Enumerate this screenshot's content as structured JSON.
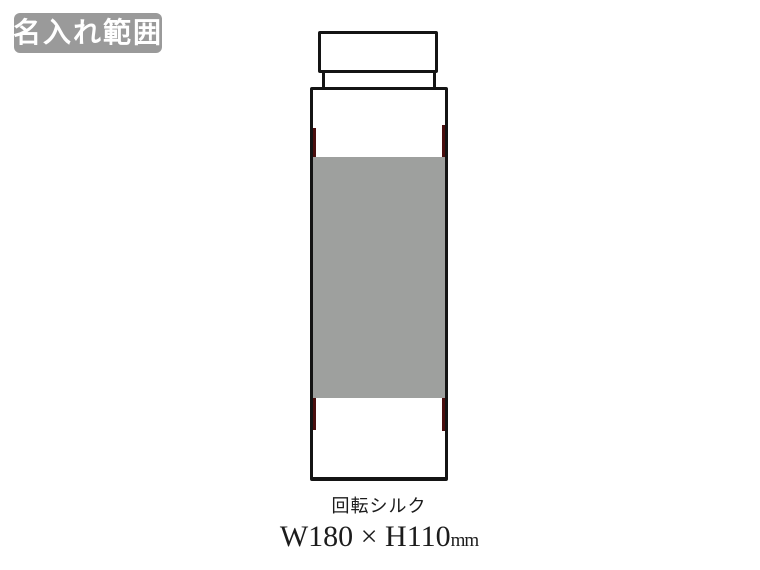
{
  "badge": {
    "label": "名入れ範囲"
  },
  "diagram": {
    "bottle_parts": [
      "cap",
      "neck-band",
      "body"
    ],
    "print_area_shape": "rectangle"
  },
  "caption": {
    "method": "回転シルク",
    "size_main": "W180 × H110",
    "size_unit": "mm"
  },
  "colors": {
    "background": "#ffffff",
    "badge_bg": "#9a9a9a",
    "badge_text": "#ffffff",
    "outline": "#141414",
    "print_fill": "#9ea09e",
    "accent": "#4a0e0e",
    "text": "#1c1c1c"
  }
}
